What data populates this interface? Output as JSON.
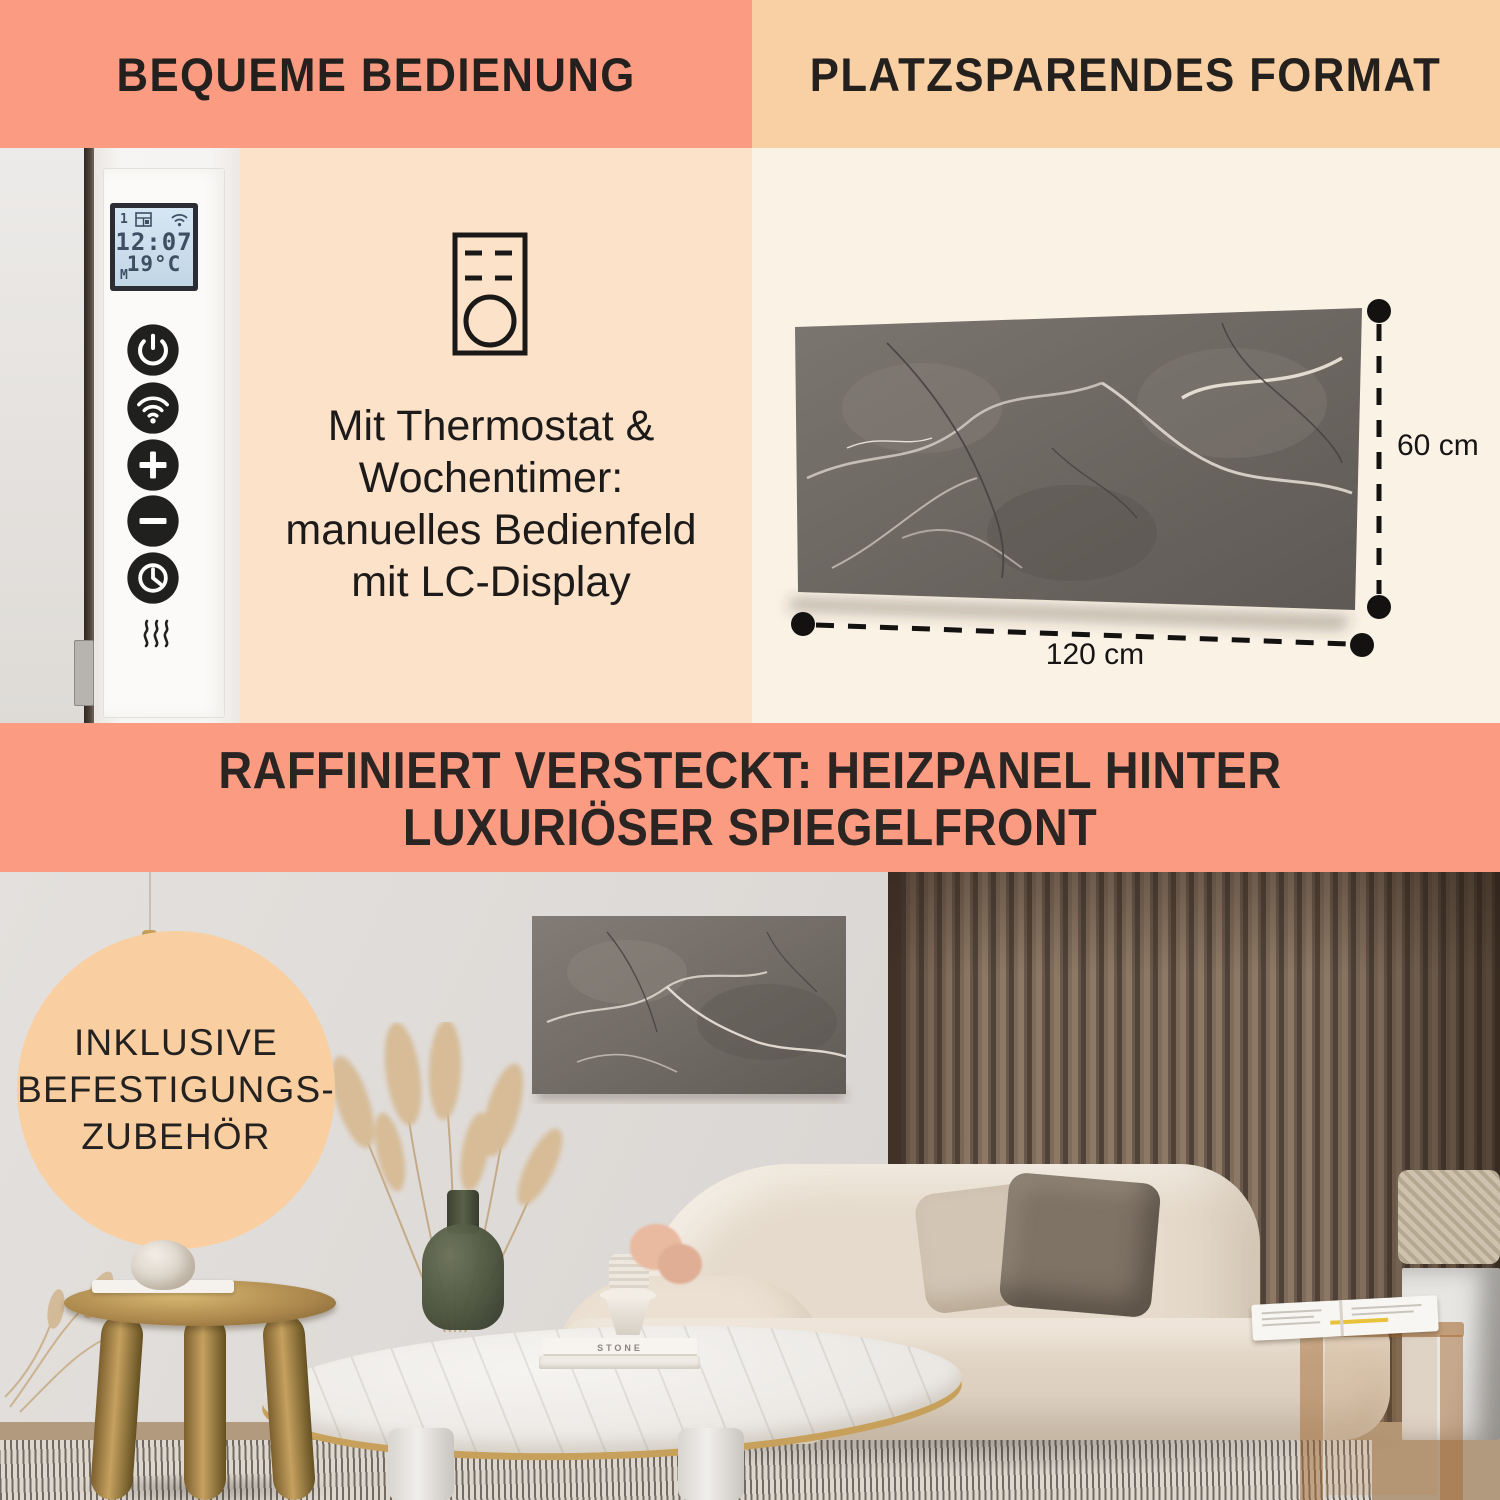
{
  "colors": {
    "salmon": "#FB9B82",
    "peach": "#F9CFA4",
    "peach_light": "#FCE2C9",
    "cream": "#FBF2E6",
    "text_dark": "#1F1D1B"
  },
  "sections": {
    "top_left_header": "BEQUEME BEDIENUNG",
    "top_right_header": "PLATZSPARENDES FORMAT",
    "middle_banner_line1": "RAFFINIERT VERSTECKT: HEIZPANEL HINTER",
    "middle_banner_line2": "LUXURIÖSER SPIEGELFRONT"
  },
  "control_panel": {
    "lcd": {
      "day_index": "1",
      "time": "12:07",
      "temperature": "19°C",
      "mode": "M"
    },
    "buttons": [
      "power",
      "wifi",
      "plus",
      "minus",
      "timer"
    ],
    "heat_indicator": "heat-waves-icon"
  },
  "feature_text": {
    "line1": "Mit Thermostat &",
    "line2": "Wochentimer:",
    "line3": "manuelles Bedienfeld",
    "line4": "mit LC-Display"
  },
  "dimensions": {
    "height": "60 cm",
    "width": "120 cm"
  },
  "badge": {
    "line1": "INKLUSIVE",
    "line2": "BEFESTIGUNGS-",
    "line3": "ZUBEHÖR"
  },
  "decor": {
    "book_spine": "STONE"
  }
}
